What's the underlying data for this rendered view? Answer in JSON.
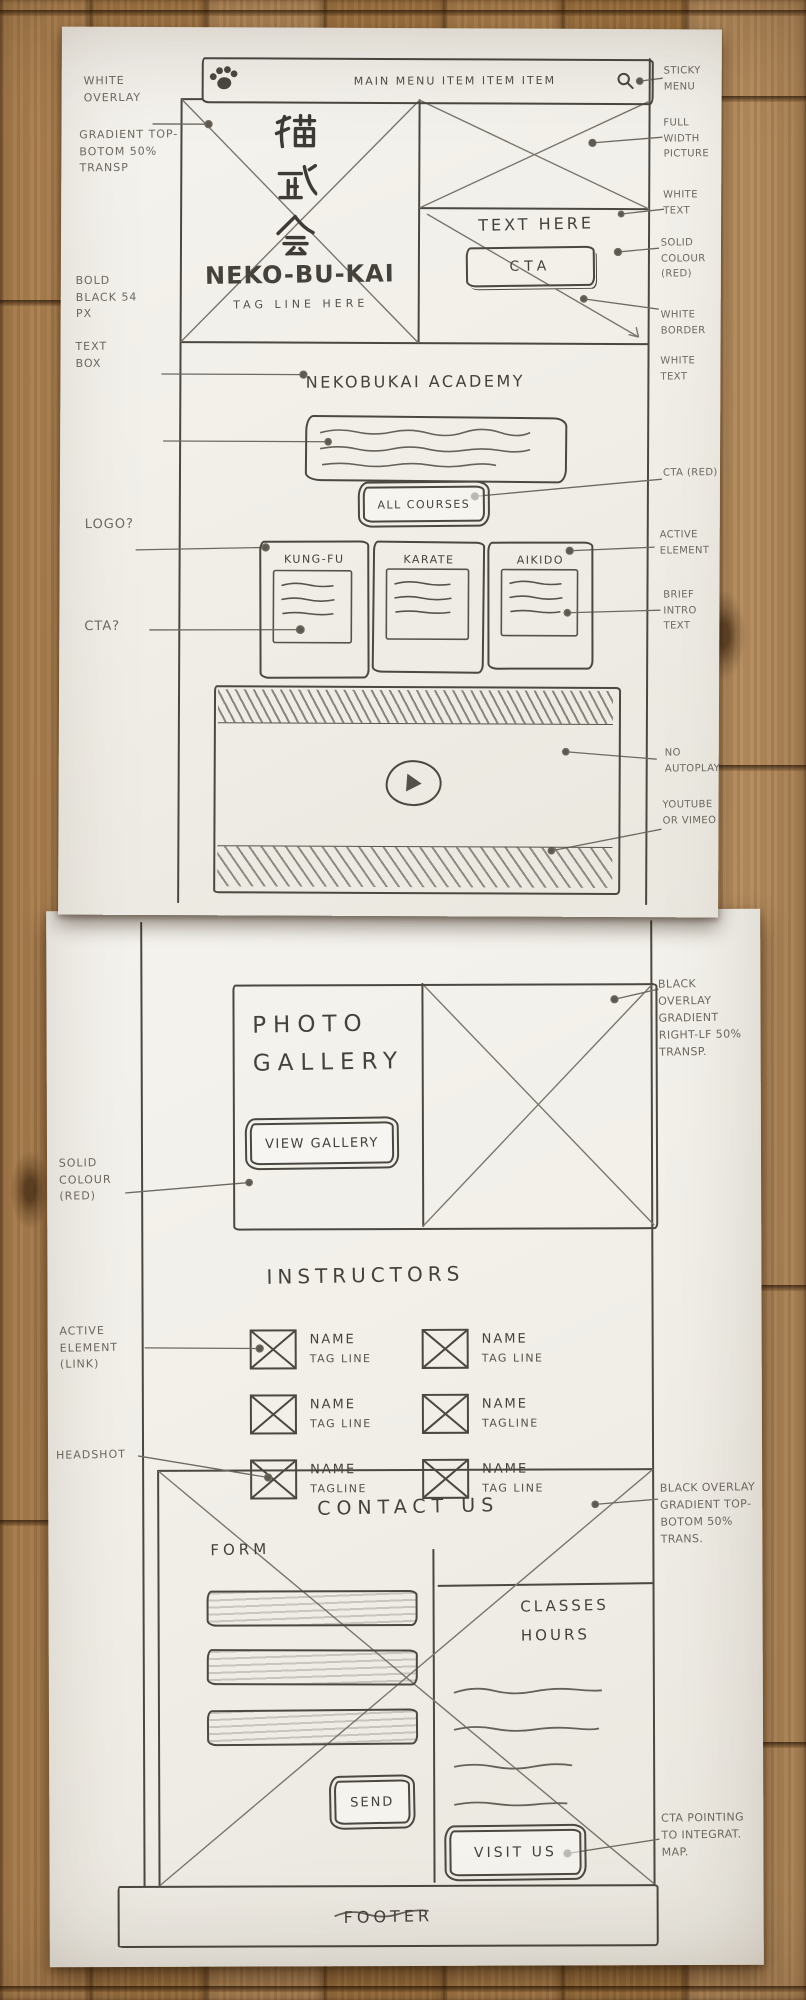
{
  "colors": {
    "paper": "#f1efe8",
    "pencil": "#6e6a62",
    "ink": "#4b4741",
    "wood": "#b1854f"
  },
  "icons": {
    "logo": "cat-paw-icon",
    "search": "magnifier-icon",
    "play": "play-icon"
  },
  "sheet1": {
    "menu": {
      "items_label": "MAIN MENU ITEM ITEM ITEM"
    },
    "hero": {
      "kanji": [
        "猫",
        "武",
        "会"
      ],
      "title": "NEKO-BU-KAI",
      "tagline": "TAG LINE HERE",
      "side_text": "TEXT HERE",
      "cta": "CTA"
    },
    "academy": {
      "heading": "NEKOBUKAI ACADEMY",
      "cta": "ALL COURSES"
    },
    "courses": [
      {
        "title": "KUNG-FU"
      },
      {
        "title": "KARATE"
      },
      {
        "title": "AIKIDO"
      }
    ],
    "notes": {
      "white_overlay": "WHITE OVERLAY",
      "gradient": "GRADIENT TOP-BOTOM 50% TRANSP",
      "bold_black": "BOLD BLACK 54 PX",
      "text_box": "TEXT BOX",
      "logo_q": "LOGO?",
      "cta_q": "CTA?",
      "sticky_menu": "STICKY MENU",
      "full_width_picture": "FULL WIDTH PICTURE",
      "white_text_top": "WHITE TEXT",
      "solid_colour_red": "SOLID COLOUR (RED)",
      "white_border": "WHITE BORDER",
      "white_text_cta": "WHITE TEXT",
      "cta_red": "CTA (RED)",
      "active_element": "ACTIVE ELEMENT",
      "brief_intro_text": "BRIEF INTRO TEXT",
      "no_autoplay": "NO AUTOPLAY",
      "youtube_or_vimeo": "YOUTUBE OR VIMEO"
    }
  },
  "sheet2": {
    "gallery": {
      "title": "PHOTO GALLERY",
      "cta": "VIEW GALLERY"
    },
    "instructors": {
      "heading": "INSTRUCTORS",
      "people": [
        {
          "name": "NAME",
          "tagline": "TAG LINE"
        },
        {
          "name": "NAME",
          "tagline": "TAG LINE"
        },
        {
          "name": "NAME",
          "tagline": "TAG LINE"
        },
        {
          "name": "NAME",
          "tagline": "TAGLINE"
        },
        {
          "name": "NAME",
          "tagline": "TAGLINE"
        },
        {
          "name": "NAME",
          "tagline": "TAG LINE"
        }
      ]
    },
    "contact": {
      "heading": "CONTACT US",
      "form_label": "FORM",
      "send": "SEND",
      "classes_heading": "CLASSES HOURS",
      "visit": "VISIT US"
    },
    "footer": {
      "label": "FOOTER"
    },
    "notes": {
      "black_overlay_right": "BLACK OVERLAY GRADIENT RIGHT-LF 50% TRANSP.",
      "solid_colour_red": "SOLID COLOUR (RED)",
      "active_element_link": "ACTIVE ELEMENT (LINK)",
      "headshot": "HEADSHOT",
      "black_overlay_top": "BLACK OVERLAY GRADIENT TOP-BOTOM 50% TRANS.",
      "cta_map": "CTA POINTING TO INTEGRAT. MAP."
    }
  }
}
